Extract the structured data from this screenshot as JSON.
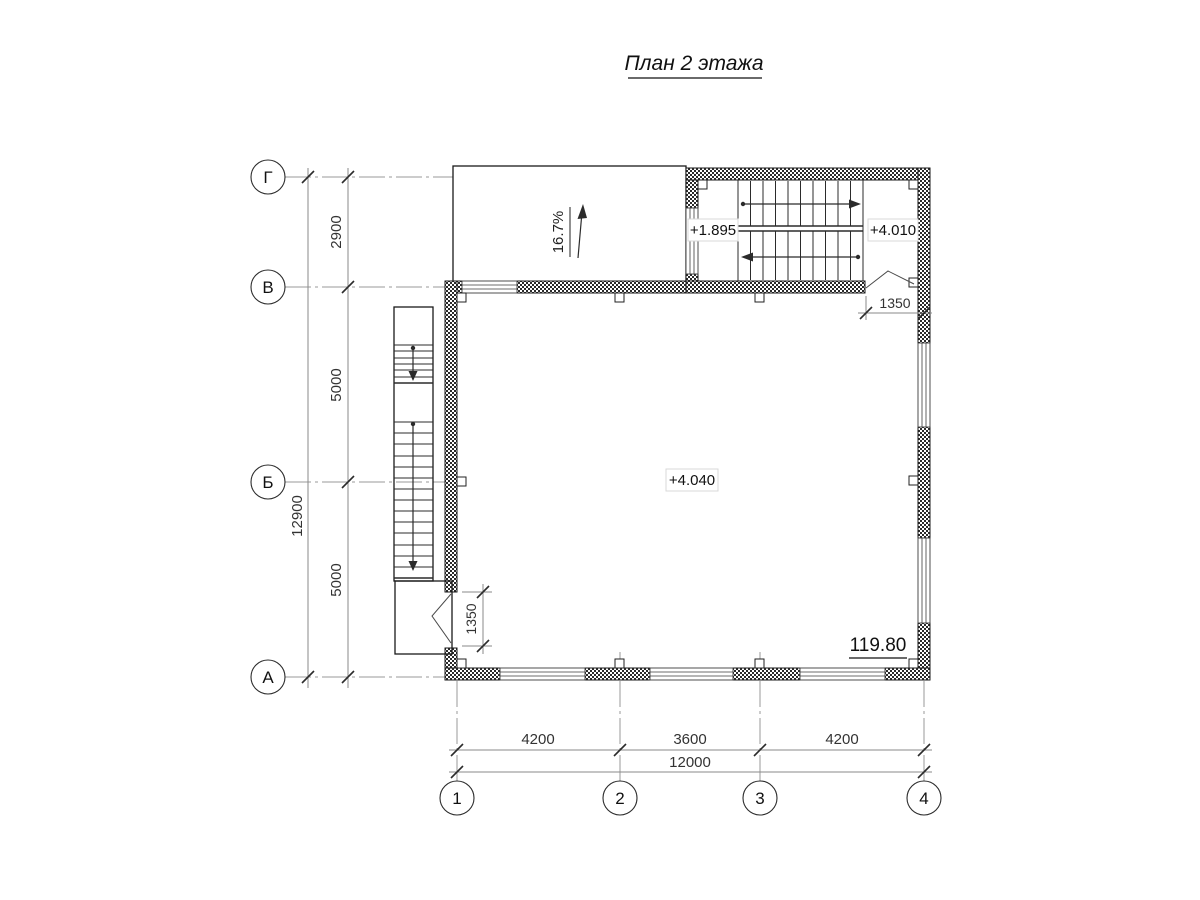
{
  "title": "План 2 этажа",
  "axes": {
    "horizontal": [
      {
        "label": "Г"
      },
      {
        "label": "В"
      },
      {
        "label": "Б"
      },
      {
        "label": "А"
      }
    ],
    "vertical": [
      {
        "label": "1"
      },
      {
        "label": "2"
      },
      {
        "label": "3"
      },
      {
        "label": "4"
      }
    ]
  },
  "dimensions": {
    "left": {
      "overall": "12900",
      "segments": [
        "2900",
        "5000",
        "5000"
      ]
    },
    "bottom": {
      "overall": "12000",
      "segments": [
        "4200",
        "3600",
        "4200"
      ]
    },
    "left_door": "1350",
    "right_door": "1350"
  },
  "annotations": {
    "ramp_slope": "16.7%",
    "stair_mid_level": "+1.895",
    "stair_top_level": "+4.010",
    "floor_level": "+4.040",
    "room_area": "119.80"
  }
}
